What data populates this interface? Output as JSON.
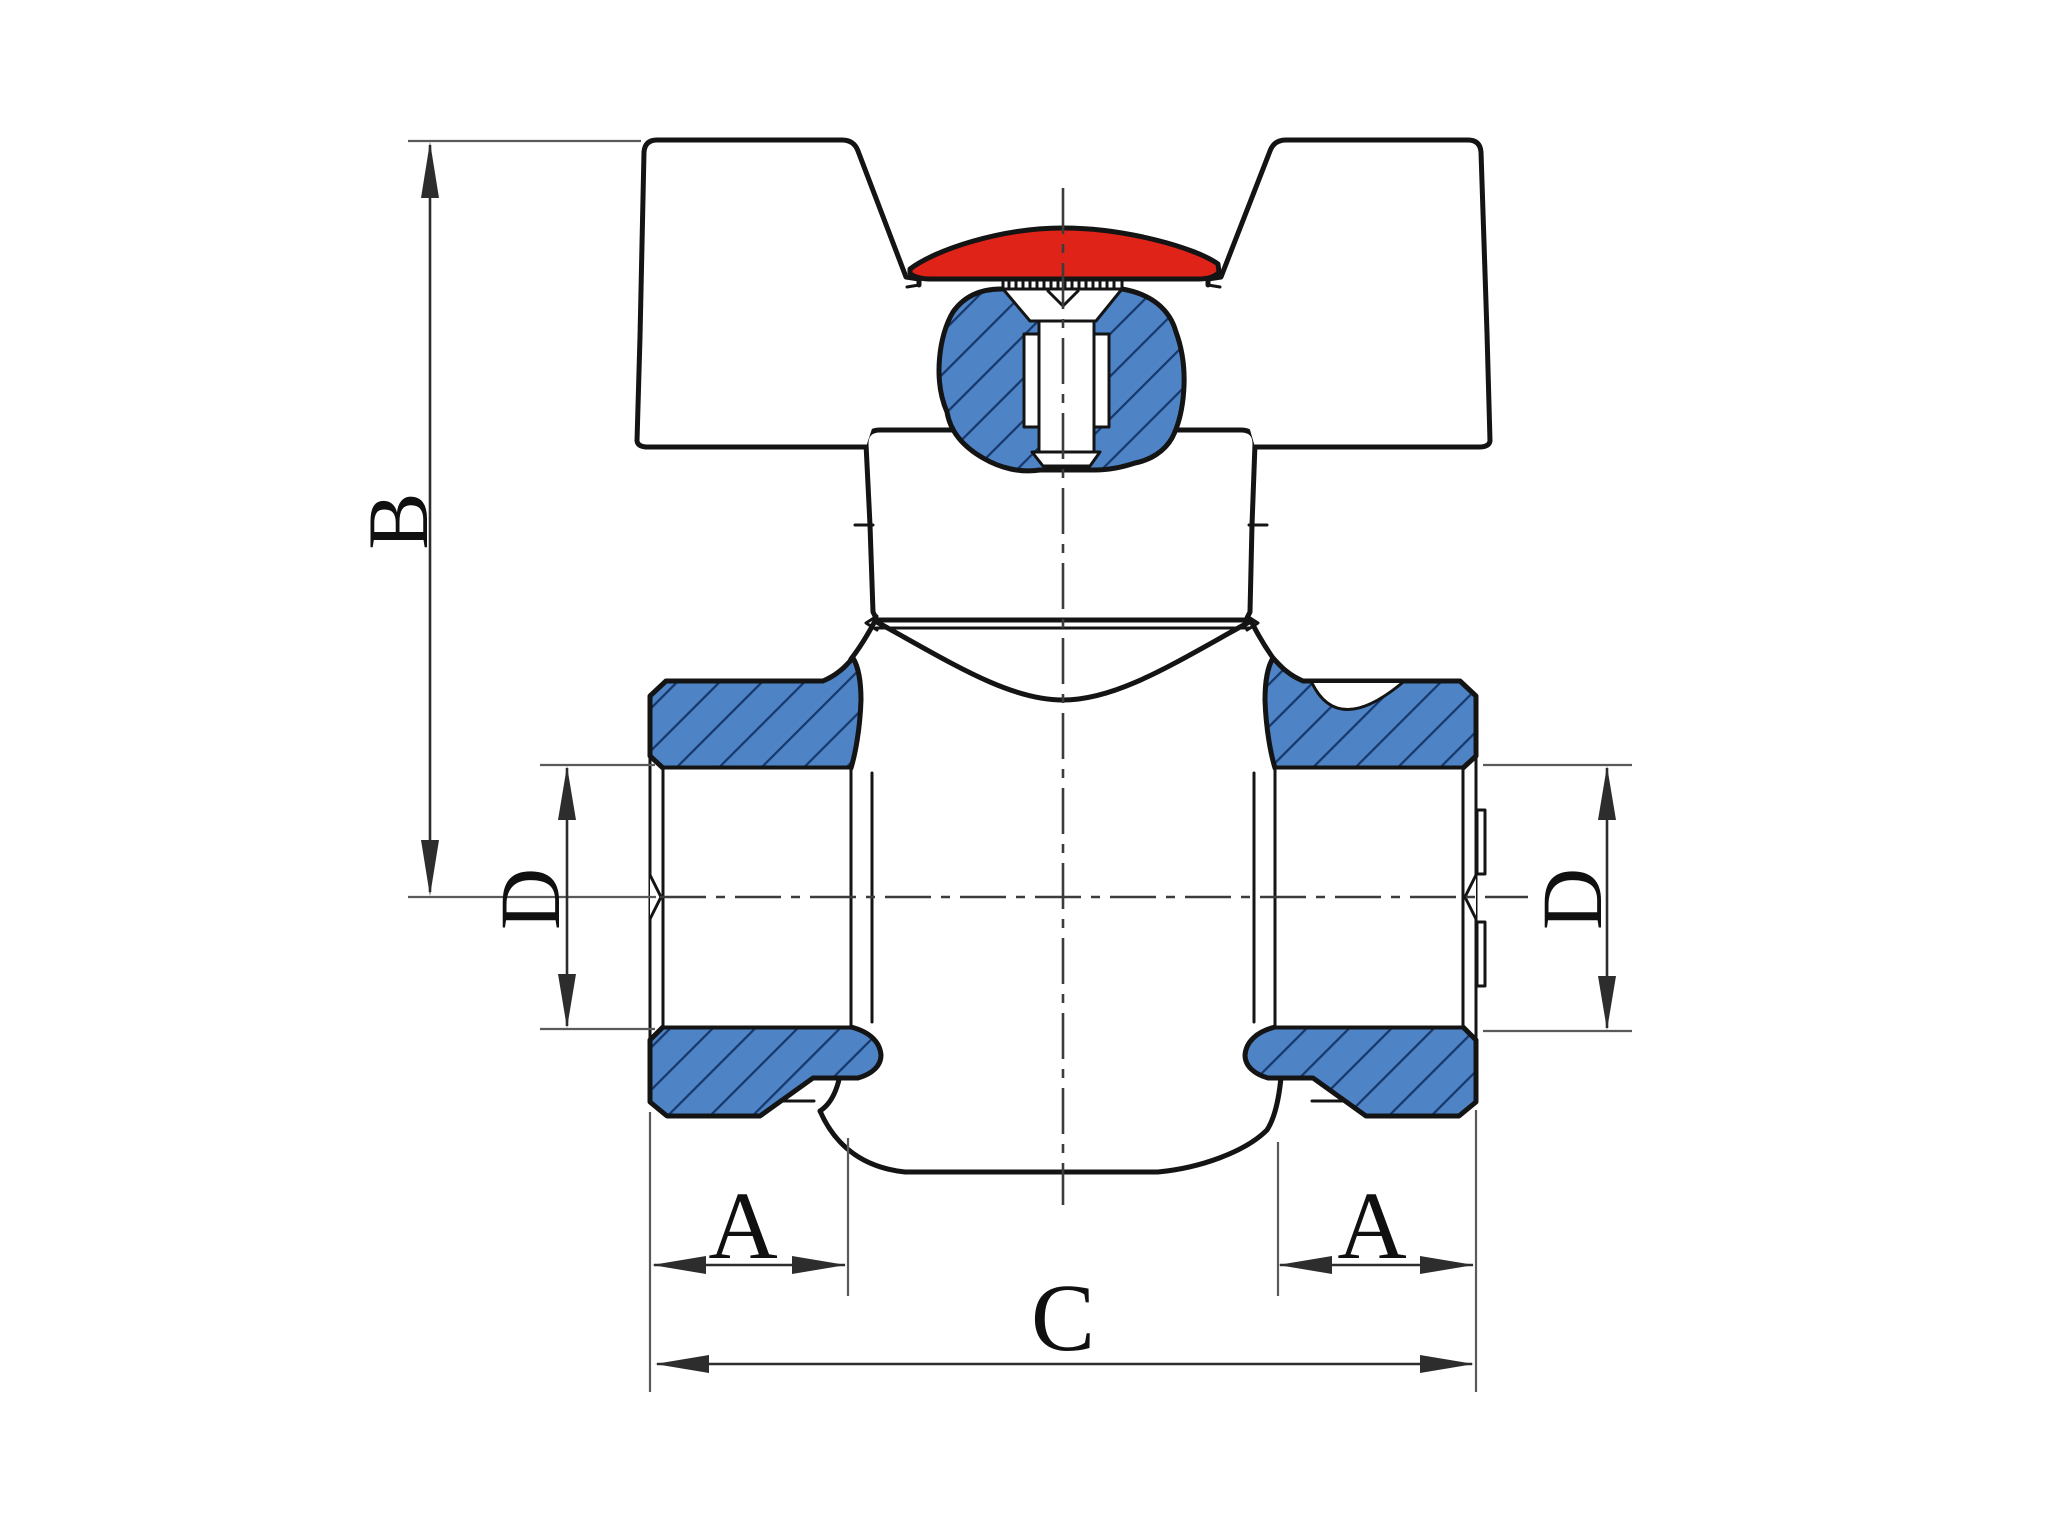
{
  "drawing": {
    "kind": "ball-valve-sectional-diagram",
    "view": "front cross-section of a ball valve with butterfly (tee) handle",
    "background": "#ffffff"
  },
  "dimension_labels": {
    "b": "B",
    "d_left": "D",
    "d_right": "D",
    "a_left": "A",
    "a_right": "A",
    "c": "C"
  },
  "annotations": [
    {
      "label": "B",
      "orientation": "vertical",
      "location": "far left, from handle top to pipe centerline"
    },
    {
      "label": "D",
      "orientation": "vertical",
      "location": "left of left port, bore diameter"
    },
    {
      "label": "D",
      "orientation": "vertical",
      "location": "right of right port, bore diameter"
    },
    {
      "label": "A",
      "orientation": "horizontal",
      "location": "below left port, thread length"
    },
    {
      "label": "A",
      "orientation": "horizontal",
      "location": "below right port, thread length"
    },
    {
      "label": "C",
      "orientation": "horizontal",
      "location": "bottom, overall end-to-end length"
    }
  ],
  "parts": [
    {
      "name": "tee-handle",
      "fill": "white"
    },
    {
      "name": "handle-cap",
      "fill": "#df2318"
    },
    {
      "name": "bonnet-neck",
      "fill": "white"
    },
    {
      "name": "valve-body",
      "fill": "white"
    },
    {
      "name": "stem-gland-section",
      "fill": "#4e83c6",
      "hatch": "#16386b"
    },
    {
      "name": "left-port-nut",
      "fill": "#4e83c6",
      "hatch": "#16386b"
    },
    {
      "name": "right-port-nut",
      "fill": "#4e83c6",
      "hatch": "#16386b"
    }
  ],
  "colors": {
    "accent-red": "#df2318",
    "hatch-blue": "#4e83c6",
    "hatch-line": "#16386b",
    "outline": "#141414",
    "dim-line": "#2d2d2d",
    "ext-line": "#5a5a5a",
    "center-line": "#3c3c3c"
  }
}
